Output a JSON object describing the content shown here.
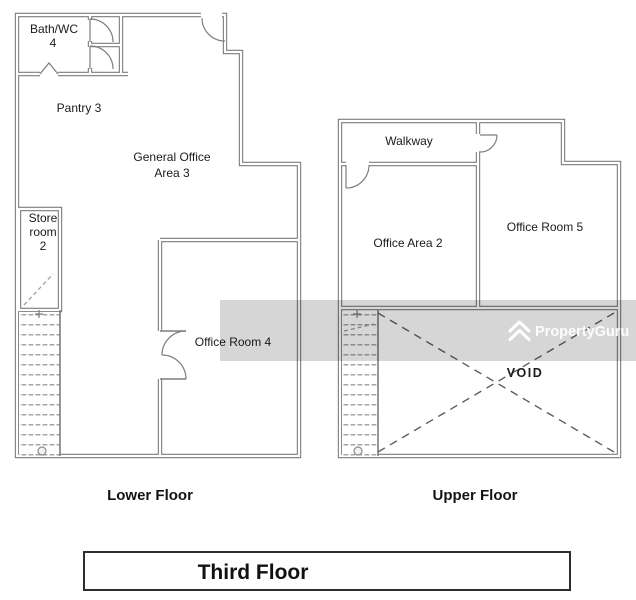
{
  "title_block": {
    "label": "Third Floor"
  },
  "floors": {
    "lower": {
      "caption": "Lower Floor",
      "rooms": {
        "bath_wc_line1": "Bath/WC",
        "bath_wc_line2": "4",
        "pantry": "Pantry 3",
        "general_office_line1": "General Office",
        "general_office_line2": "Area 3",
        "store_line1": "Store",
        "store_line2": "room",
        "store_line3": "2",
        "office_room_4": "Office Room 4"
      }
    },
    "upper": {
      "caption": "Upper Floor",
      "rooms": {
        "walkway": "Walkway",
        "office_area_2": "Office Area 2",
        "office_room_5": "Office Room 5",
        "void": "VOID"
      }
    }
  },
  "watermark": {
    "brand": "PropertyGuru"
  },
  "colors": {
    "wall": "#7d7d7d",
    "text": "#1b1b1b",
    "watermark_band": "rgba(0,0,0,0.16)",
    "watermark_text": "#ffffff"
  }
}
